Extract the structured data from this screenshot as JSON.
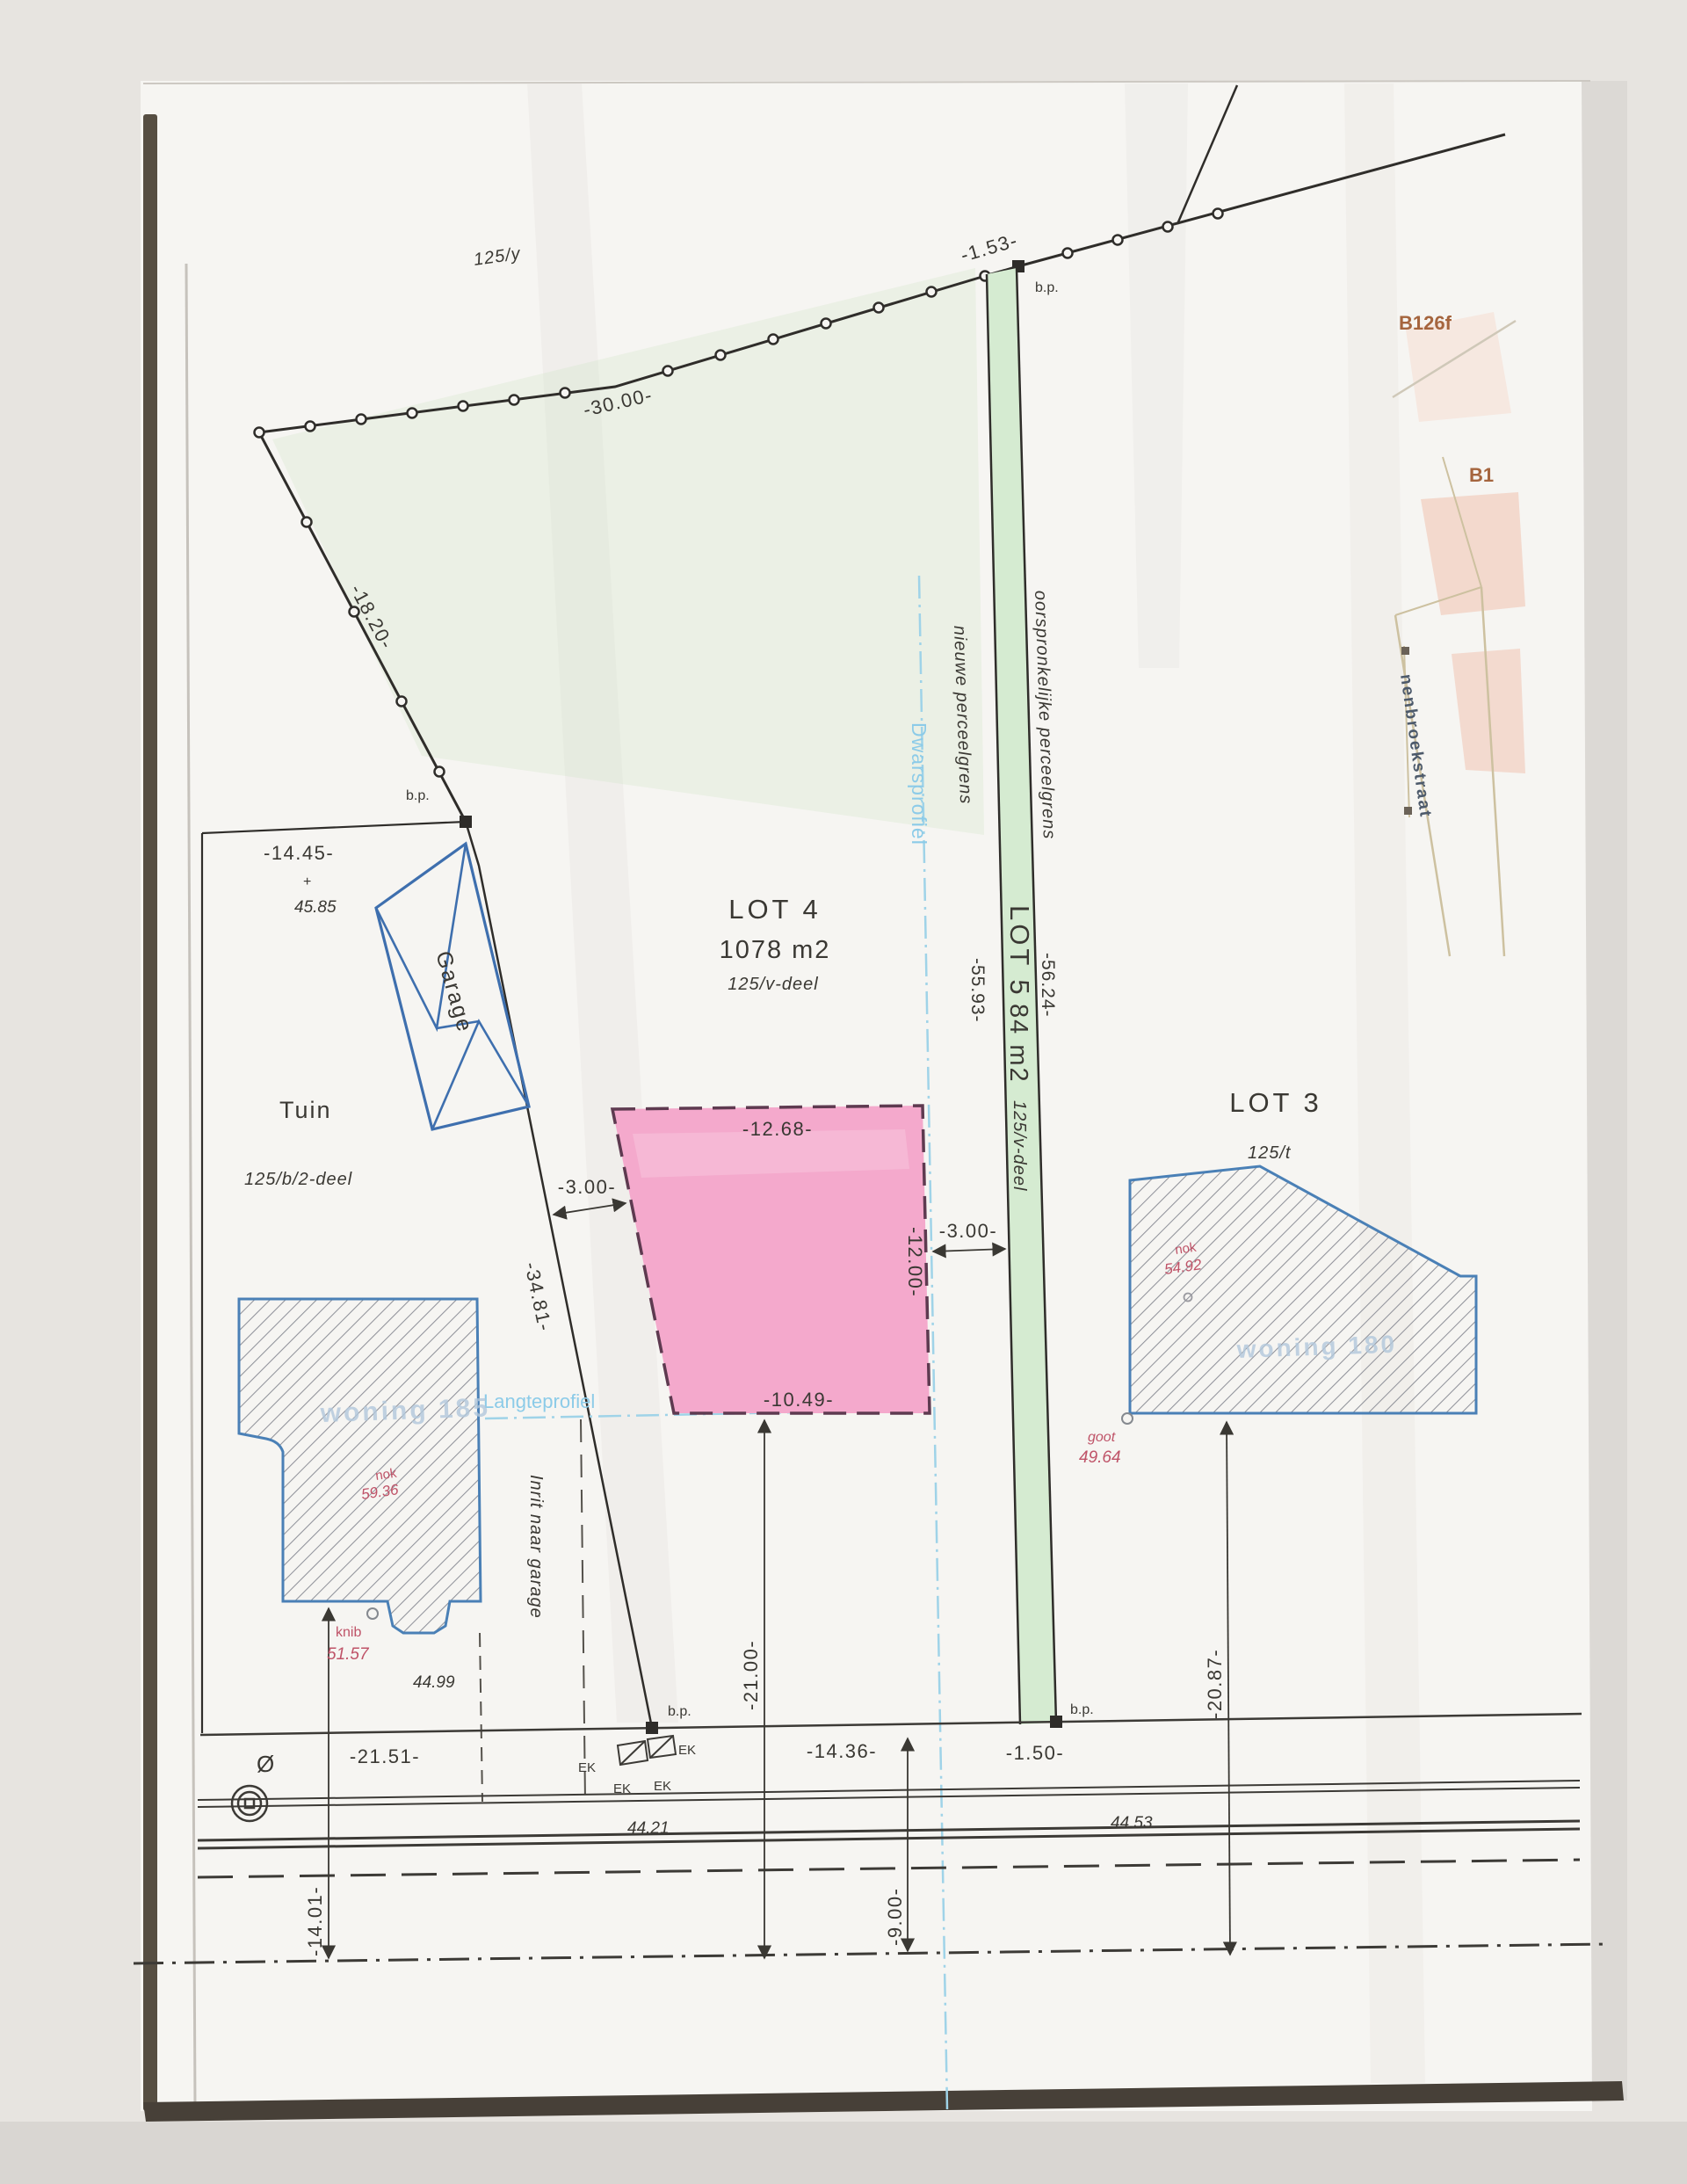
{
  "labels": {
    "parcel_125y": "125/y",
    "b126f": "B126f",
    "b1": "B1",
    "street": "nenbroekstraat",
    "lot4": "LOT 4",
    "lot4_area": "1078 m2",
    "lot4_parcel": "125/v-deel",
    "lot5": "LOT 5",
    "lot5_area": "84 m2",
    "lot5_parcel": "125/v-deel",
    "lot3": "LOT 3",
    "lot3_parcel": "125/t",
    "tuin": "Tuin",
    "tuin_parcel": "125/b/2-deel",
    "garage": "Garage",
    "nieuwe": "nieuwe perceelgrens",
    "oorspronkelijke": "oorspronkelijke perceelgrens",
    "dwarsprofiel": "Dwarsprofiel",
    "langteprofiel": "Langteprofiel",
    "inrit": "Inrit naar garage",
    "woning_left": "woning 185",
    "woning_right": "woning 180",
    "bp": "b.p.",
    "ek": "EK",
    "diameter": "Ø",
    "plus": "+"
  },
  "dimensions": {
    "d30": "-30.00-",
    "d1_53": "-1.53-",
    "d18_20": "-18.20-",
    "d14_45": "-14.45-",
    "d34_81": "-34.81-",
    "d55_93": "-55.93-",
    "d56_24": "-56.24-",
    "d12_68": "-12.68-",
    "d12_00": "-12.00-",
    "d3_00": "-3.00-",
    "d10_49": "-10.49-",
    "d21_51": "-21.51-",
    "d14_36": "-14.36-",
    "d1_50": "-1.50-",
    "d21_00": "-21.00-",
    "d9_00": "-9.00-",
    "d14_01": "-14.01-",
    "d20_87": "-20.87-"
  },
  "levels": {
    "v45_85": "45.85",
    "v44_99": "44.99",
    "v44_21": "44.21",
    "v44_53": "44.53",
    "knib": "knib",
    "knib_value": "51.57",
    "goot": "goot",
    "goot_value": "49.64",
    "nok": "nok",
    "nok_left_value": "59.36",
    "nok_right_value": "54.92"
  },
  "colors": {
    "lot5_strip_green": "#d5ebd1",
    "building_envelope_pink": "#f4a9cc",
    "envelope_dash_maroon": "#5e3a50",
    "building_outline_blue": "#4a80b6",
    "annotation_red": "#bf5368",
    "profile_cyan": "#8ccbe8",
    "parcel_label_brown": "#a5653e",
    "paper": "#f6f5f2"
  }
}
